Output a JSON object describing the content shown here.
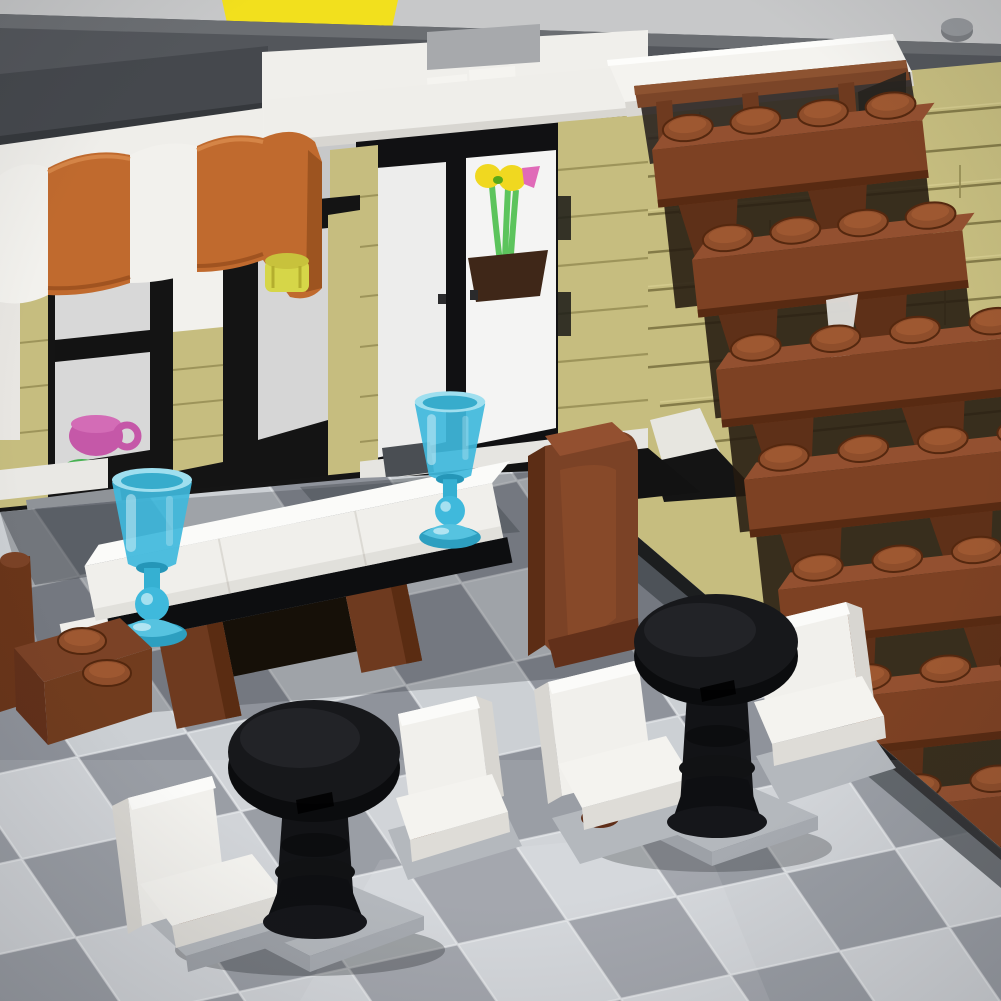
{
  "image": {
    "type": "photograph",
    "subject": "LEGO modular building cafe interior diorama",
    "width_px": 1001,
    "height_px": 1001
  },
  "palette": {
    "backdrop": "#c7c8c9",
    "roof_top": "#6b6e72",
    "roof_face": "#53565b",
    "roof_dark": "#45484d",
    "roof_lip": "#35383c",
    "yellow_tile": "#f2e01d",
    "white_brick": "#f0efeb",
    "white_bright": "#fbfbf9",
    "white_shadow": "#d8d6d1",
    "awning_orange": "#c06a2e",
    "awning_orange_dark": "#9d5420",
    "awning_white": "#f2f1ed",
    "trans_yellow": "#d6d648",
    "tan": "#c6bd7f",
    "tan_light": "#d9d094",
    "tan_dark": "#948b52",
    "tan_groove": "#6f6636",
    "black_frame": "#111113",
    "glass": "#ededec",
    "flower_yellow": "#f0d820",
    "flower_pink": "#e06ab8",
    "stem_green": "#5cc45c",
    "pot_brown": "#3f2718",
    "brown": "#7b4226",
    "brown_light": "#935030",
    "brown_dark": "#5c2d15",
    "stud_brown": "#8f4e2b",
    "goblet_blue": "#3fb9dc",
    "goblet_blue_light": "#9fdfef",
    "goblet_blue_dark": "#1f93b5",
    "cafe_table_black": "#17181b",
    "floor_light": "#ccd0d4",
    "floor_mid": "#8f939b",
    "floor_seam": "#e9ebee",
    "seat_base_gray": "#b4b8bd",
    "magenta_cup": "#c558a8"
  },
  "scene": {
    "backdrop": {
      "label": "studio backdrop"
    },
    "roofline": {
      "label": "dark gray roof plates"
    },
    "yellow_tile": {
      "label": "yellow tile above roofline"
    },
    "awning": {
      "label": "orange and white striped cafe awning",
      "stripe_count": 5,
      "stripe_colors": [
        "white",
        "orange"
      ]
    },
    "shop_window": {
      "label": "left shop window with magenta cup and plant"
    },
    "bay_window": {
      "label": "center bay window with flower bouquet"
    },
    "flowers": {
      "label": "yellow and pink flowers with green stems in pot"
    },
    "tan_wall": {
      "label": "tan brick wall"
    },
    "landing": {
      "label": "white balcony landing tile"
    },
    "railing": {
      "label": "reddish brown stair railing"
    },
    "staircase": {
      "label": "reddish brown brick staircase",
      "steps": 7,
      "studs_per_step": 4
    },
    "dining_table": {
      "label": "white dining table with black base and brown legs"
    },
    "goblets": {
      "label": "transparent light blue goblets",
      "count": 2
    },
    "chair_left": {
      "label": "brown chair with exposed studs"
    },
    "chair_center": {
      "label": "brown high-back chair"
    },
    "cafe_tables": {
      "label": "black round pedestal cafe tables",
      "count": 2
    },
    "booth_seats": {
      "label": "white booth seats on gray tile bases",
      "count": 4
    },
    "floor": {
      "label": "light and medium gray checkerboard tile floor"
    }
  }
}
